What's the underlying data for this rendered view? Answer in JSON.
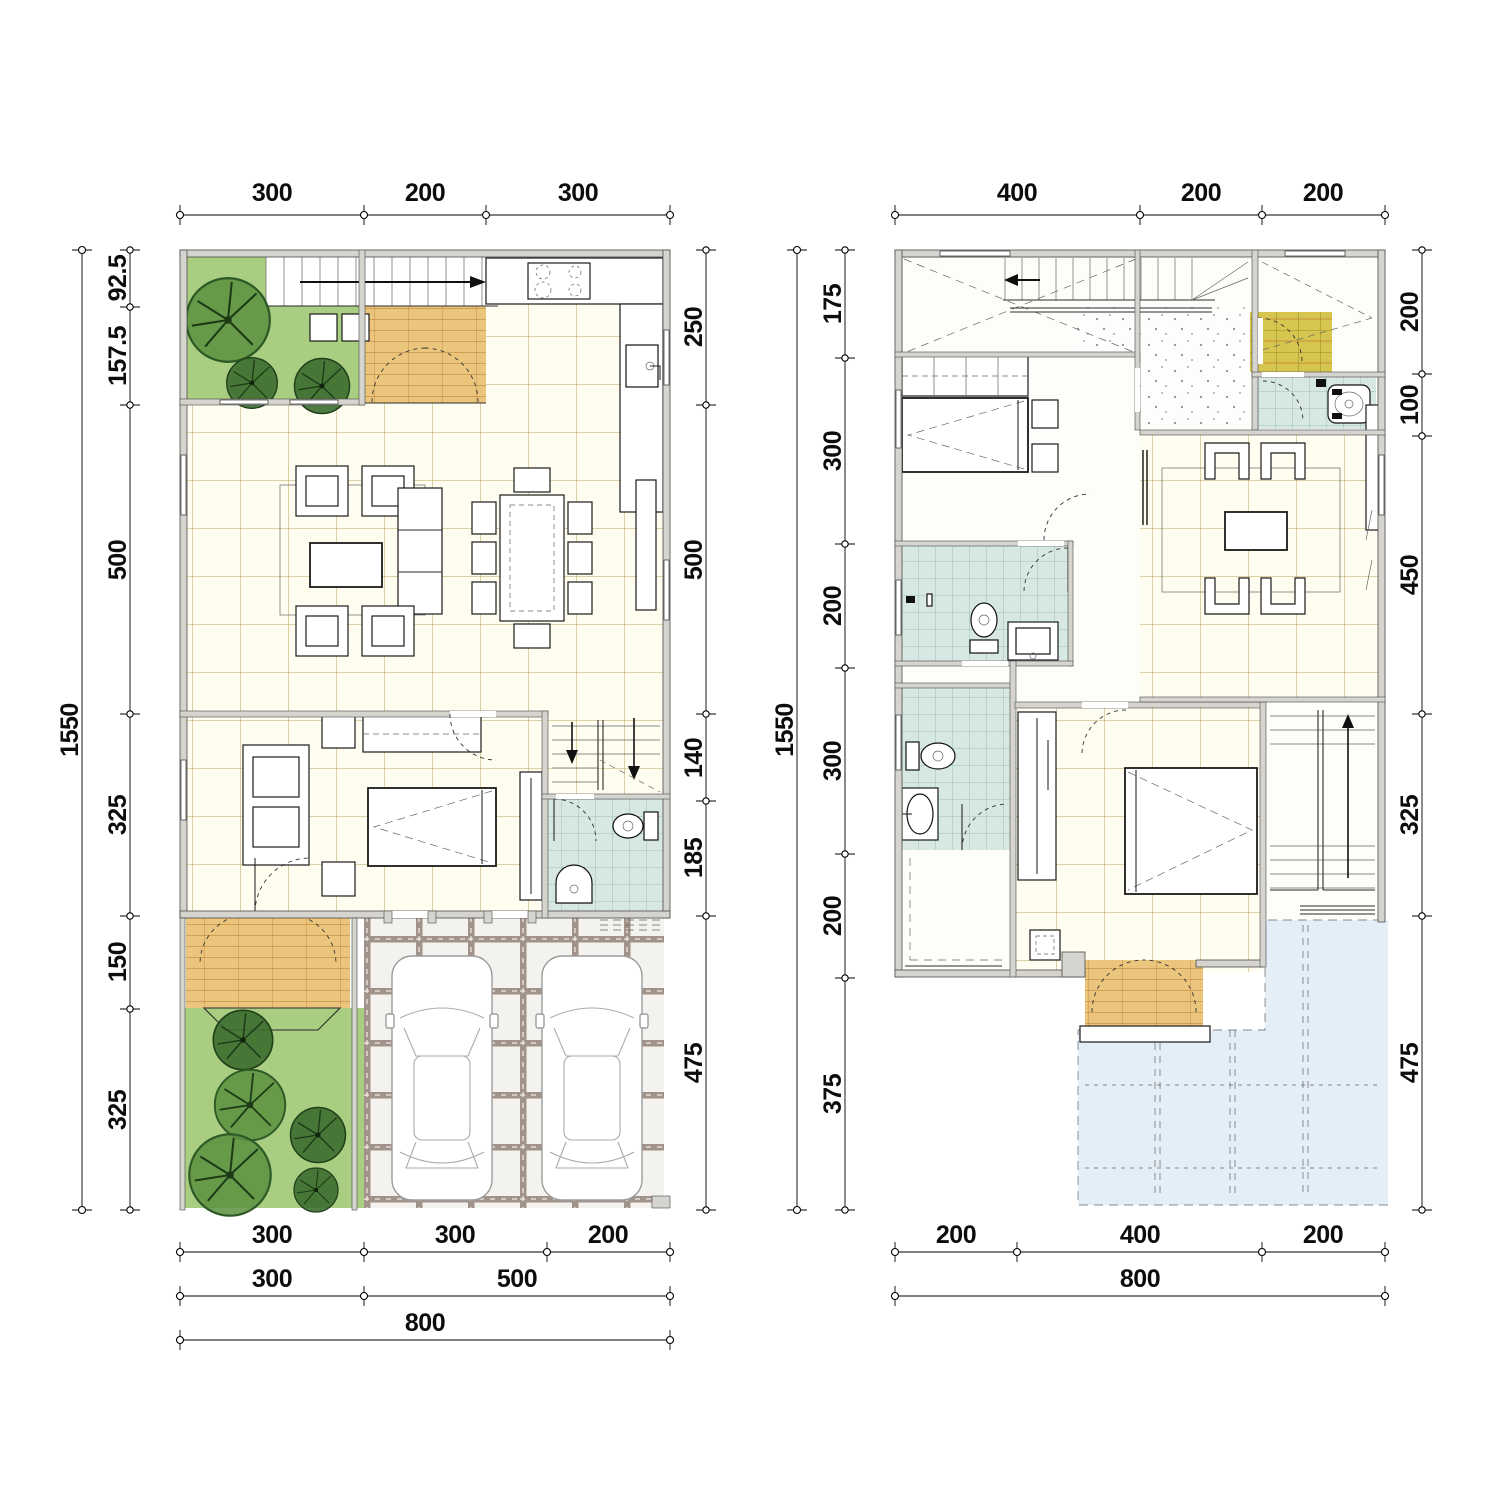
{
  "document": {
    "type": "architectural-floor-plans",
    "sheet_background": "#ffffff",
    "units_note": "centimeter dimension chains as drawn"
  },
  "plans": {
    "ground": {
      "name": "ground-floor-plan",
      "dims_top": [
        "300",
        "200",
        "300"
      ],
      "dim_total_left": "1550",
      "dims_left": [
        "92.5",
        "157.5",
        "500",
        "325",
        "150",
        "325"
      ],
      "dims_right": [
        "250",
        "500",
        "140",
        "185",
        "475"
      ],
      "dims_bottom_row1": [
        "300",
        "300",
        "200"
      ],
      "dims_bottom_row2": [
        "300",
        "500"
      ],
      "dims_bottom_row3": [
        "800"
      ]
    },
    "upper": {
      "name": "upper-floor-plan",
      "dims_top": [
        "400",
        "200",
        "200"
      ],
      "dim_total_left": "1550",
      "dims_left": [
        "175",
        "300",
        "200",
        "300",
        "200",
        "375"
      ],
      "dims_right": [
        "200",
        "100",
        "450",
        "325",
        "475"
      ],
      "dims_bottom_row1": [
        "200",
        "400",
        "200"
      ],
      "dims_bottom_row2": [
        "800"
      ]
    }
  },
  "colors": {
    "wall": "#d6d4ce",
    "tile_floor": "#fffcf0",
    "tile_line": "#b8a45a",
    "bath_tile": "#d7e7e2",
    "deck_wood": "#ecc57d",
    "balcony_deck": "#d6c54e",
    "lawn": "#a9cd81",
    "tree": "#2e5a26",
    "roof_below": "#e3eef6",
    "paver_joint": "#a2938a"
  }
}
